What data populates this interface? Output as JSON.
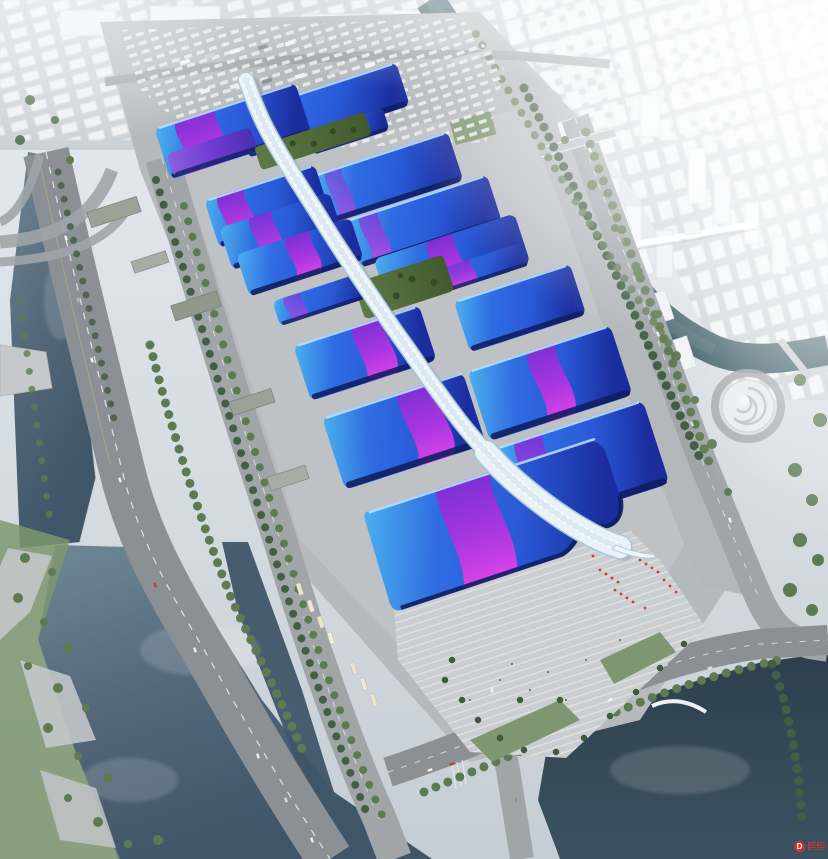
{
  "scene": {
    "description": "Aerial rendering of a riverside exhibition and convention center: paired halls with blue wave roofs and purple ribbon stripes flank a white serpentine central concourse; surrounded by a highway, canals, parking lots, a stepped entry plaza with red decorations, and a hazy white city skyline."
  },
  "watermark": {
    "logo": "D"
  },
  "palette": {
    "sky-top": "#e7edf1",
    "sky-bot": "#c6ced5",
    "haze": "#f3f6f8",
    "city-base": "#ccd3d8",
    "city-block": "#f4f6f7",
    "city-shade": "#b7c0c7",
    "water-river": "#6e8896",
    "water-deep": "#3f5568",
    "water-canal": "#47646e",
    "water-pond": "#2d3f4c",
    "water-light": "#8ba2ad",
    "road": "#8b9094",
    "road-minor": "#a0a5a8",
    "road-mark": "#dde0e1",
    "concrete": "#b7babd",
    "concrete-light": "#c9ccce",
    "plaza": "#cbced0",
    "plaza-stripe": "#e2e4e5",
    "grass": "#7e9770",
    "tree": "#5e7a53",
    "tree-dark": "#435e45",
    "palm": "#3e5d3c",
    "roof-cyan": "#4cb2ee",
    "roof-blue": "#2a5ad8",
    "roof-deep": "#1b2d9e",
    "roof-navy": "#101f62",
    "ribbon-violet": "#7c30d4",
    "ribbon-magenta": "#d844e8",
    "spine-edge": "#a8c6d8",
    "spine-base": "#e8f2f8",
    "spine-core": "#ffffff",
    "red-accent": "#cf3a32",
    "watermark-red": "#d2362e"
  }
}
